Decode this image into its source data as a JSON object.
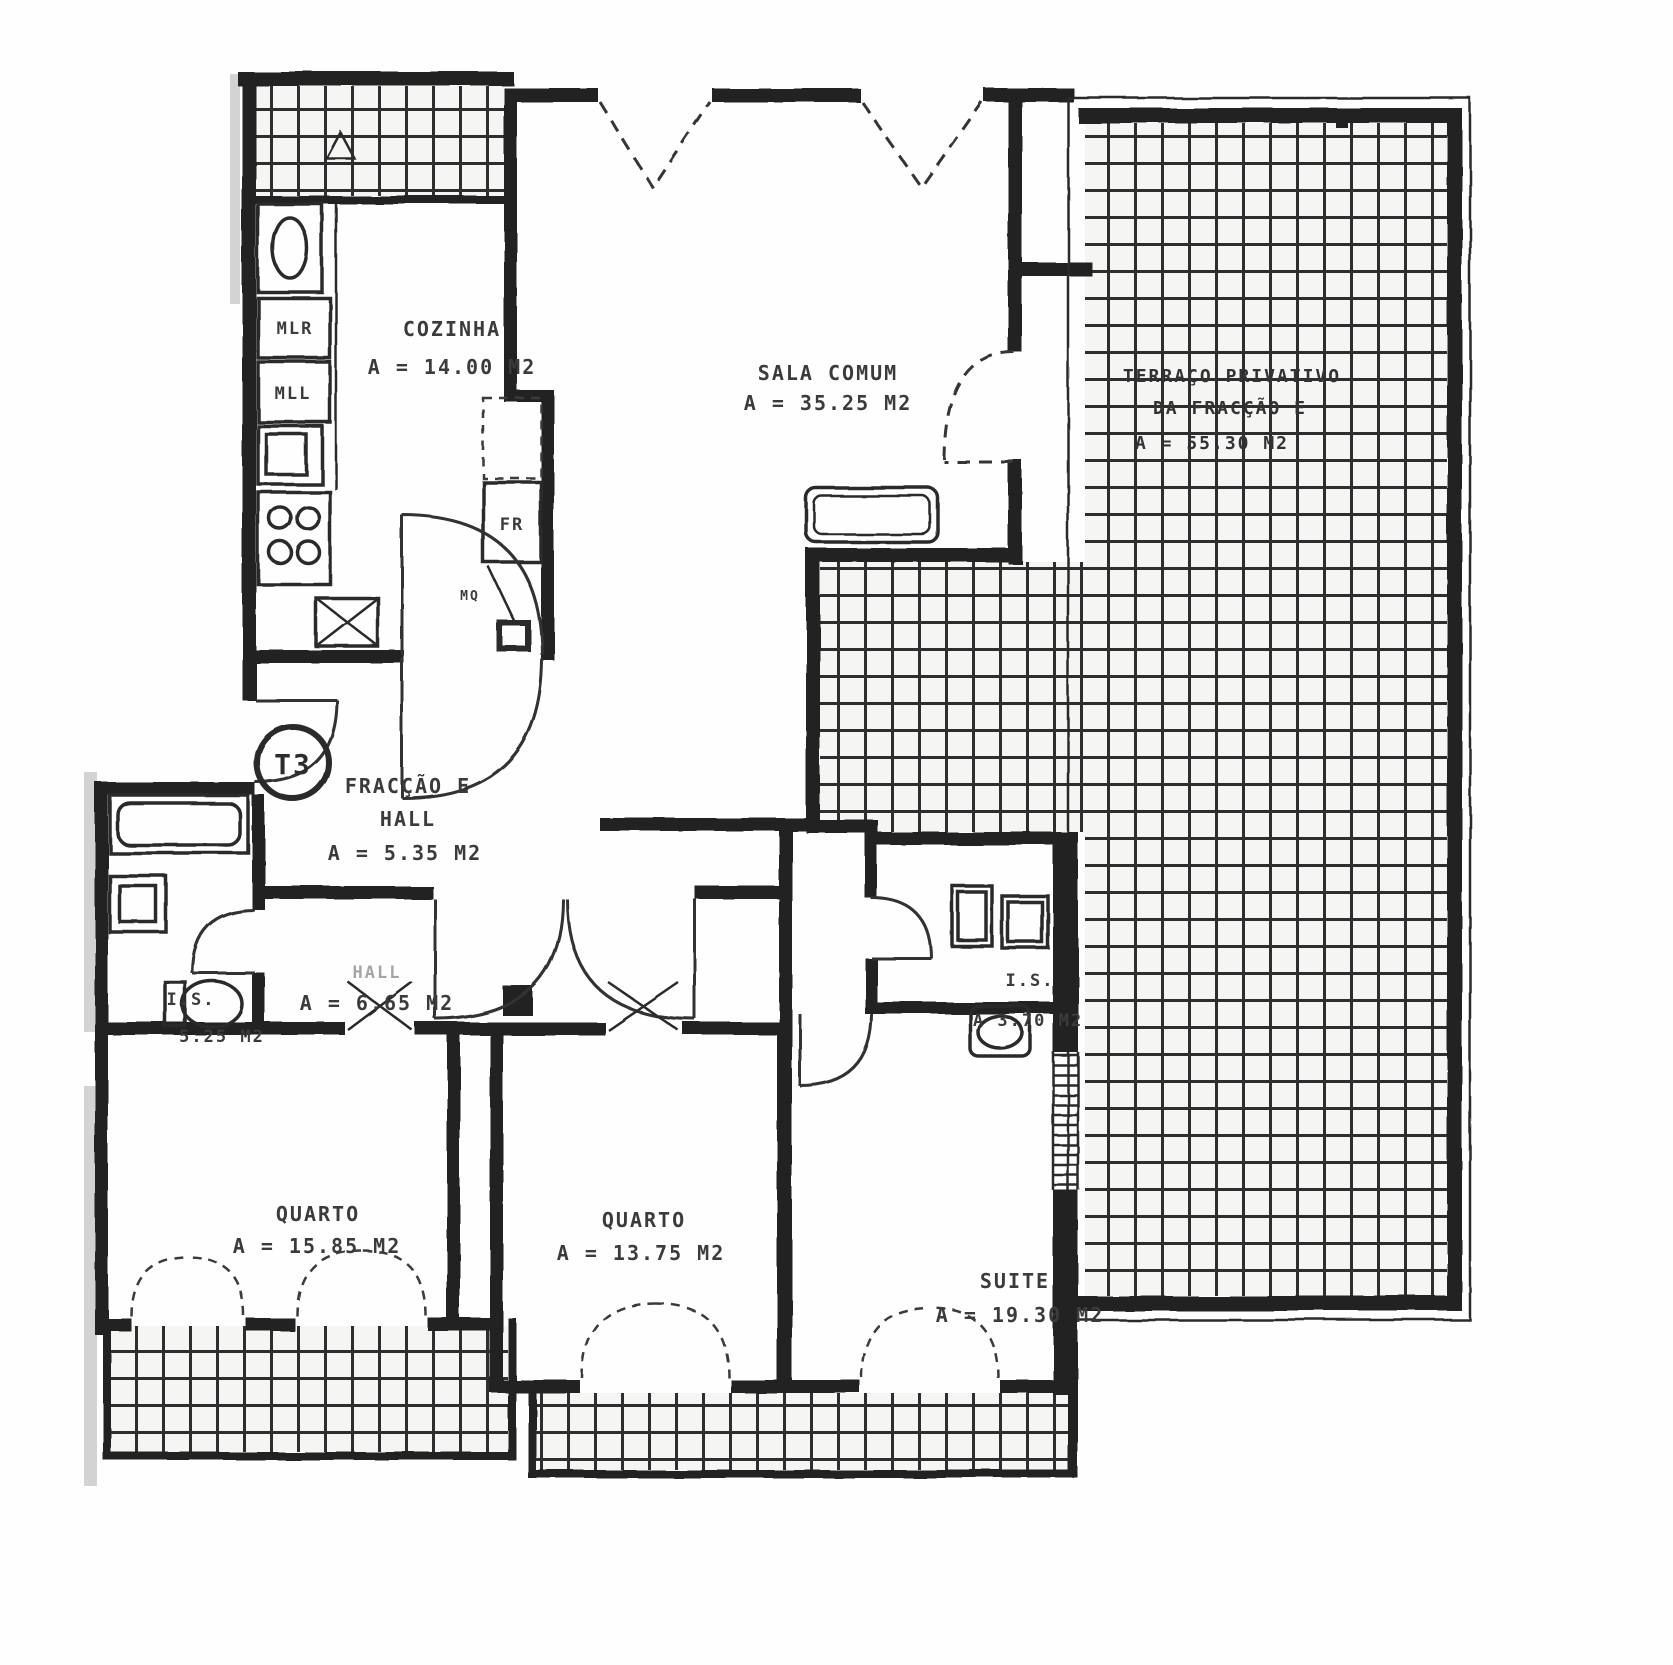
{
  "plan": {
    "unit_badge": "T3",
    "rooms": {
      "cozinha": {
        "name": "COZINHA",
        "area": "A = 14.00 M2"
      },
      "sala_comum": {
        "name": "SALA COMUM",
        "area": "A = 35.25 M2"
      },
      "terraco": {
        "line1": "TERRAÇO PRIVATIVO",
        "line2": "DA FRACÇÃO E",
        "area": "A = 55.30 M2"
      },
      "fraccao_hall": {
        "line1": "FRACÇÃO E",
        "line2": "HALL",
        "area": "A = 5.35 M2"
      },
      "hall": {
        "name": "HALL",
        "area": "A = 6.65 M2"
      },
      "is_esquerda": {
        "name": "I.S.",
        "area": "5.25 M2"
      },
      "is_direita": {
        "name": "I.S.",
        "area": "A  3.70 M2"
      },
      "quarto_1": {
        "name": "QUARTO",
        "area": "A = 15.85 M2"
      },
      "quarto_2": {
        "name": "QUARTO",
        "area": "A = 13.75 M2"
      },
      "suite": {
        "name": "SUITE",
        "area": "A = 19.30 M2"
      }
    },
    "appliances": {
      "mlr": "MLR",
      "mll": "MLL",
      "fr": "FR",
      "mq": "MQ"
    }
  }
}
